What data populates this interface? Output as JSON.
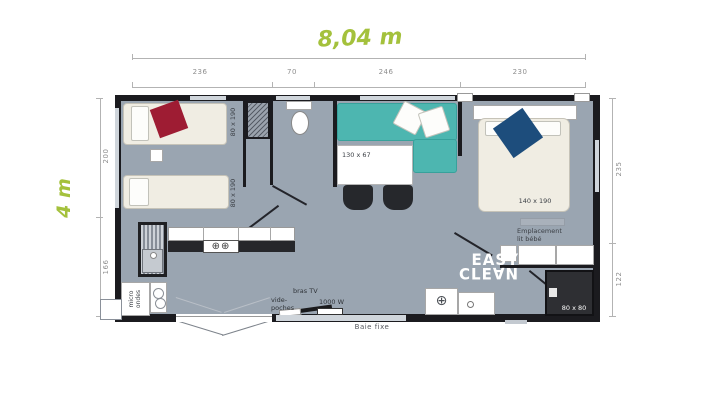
{
  "dimensions": {
    "overall_width": "8,04 m",
    "overall_height": "4 m",
    "top_segments": [
      "236",
      "70",
      "246",
      "230"
    ],
    "left_segments": [
      "200",
      "166"
    ],
    "right_segments": [
      "235",
      "122"
    ]
  },
  "rooms": {
    "bedroom_left": {
      "bed1_label": "80 x 190",
      "bed2_label": "80 x 190"
    },
    "living": {
      "table_label": "130 x 67"
    },
    "bedroom_master": {
      "bed_label": "140 x 190",
      "crib_line1": "Emplacement",
      "crib_line2": "lit bébé"
    },
    "bathroom": {
      "shower_label": "80 x 80"
    },
    "kitchen": {
      "micro_line1": "micro",
      "micro_line2": "ondes"
    }
  },
  "annotations": {
    "tv_arm": "bras TV",
    "storage_line1": "vide-",
    "storage_line2": "poches",
    "heater": "1000 W",
    "fixed_window": "Baie fixe"
  },
  "logo": {
    "line1": "EASY",
    "line2": "CLE∀N"
  },
  "colors": {
    "accent_green": "#a4c13c",
    "floor_gray": "#9aa5b1",
    "wall_black": "#1b1b1f",
    "sofa_teal": "#4db6b0",
    "pillow_red": "#9e1c33",
    "pillow_blue": "#1d4d7c",
    "shower_dark": "#2e2f33"
  }
}
